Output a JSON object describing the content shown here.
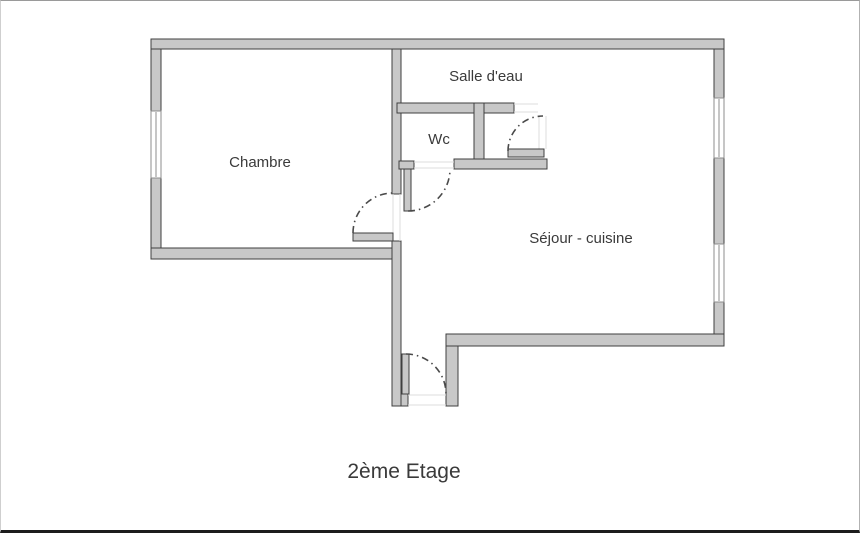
{
  "floorplan": {
    "title": "2ème Etage",
    "rooms": [
      {
        "name": "chambre",
        "label": "Chambre"
      },
      {
        "name": "salle-deau",
        "label": "Salle d'eau"
      },
      {
        "name": "wc",
        "label": "Wc"
      },
      {
        "name": "sejour-cuisine",
        "label": "Séjour - cuisine"
      }
    ]
  },
  "colors": {
    "wall_fill": "#c8c8c8",
    "wall_stroke": "#3f3f3f",
    "arc_stroke": "#4a4a4a",
    "text_color": "#3a3a3a",
    "background": "#ffffff"
  }
}
